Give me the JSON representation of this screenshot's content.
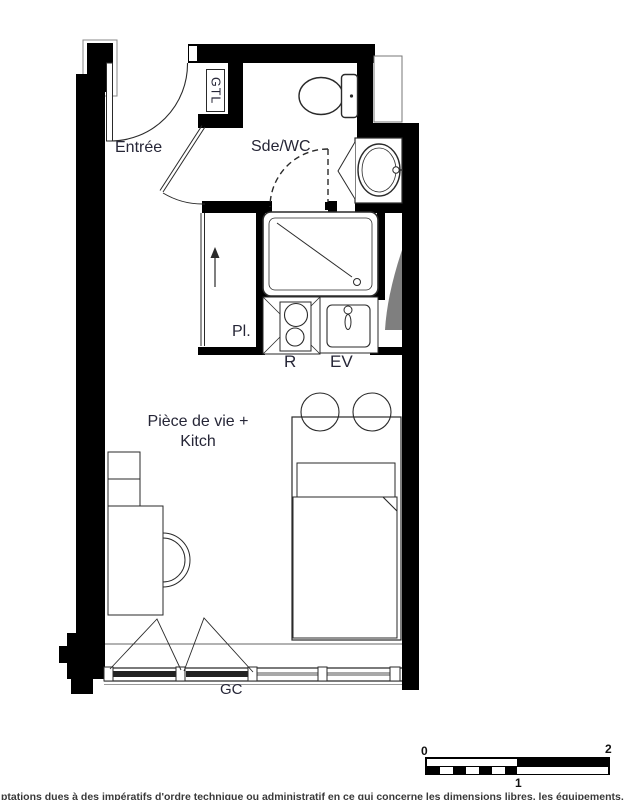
{
  "plan": {
    "title_context": "studio floor plan",
    "labels": {
      "entree": "Entrée",
      "sde_wc": "Sde/WC",
      "gtl": "GTL",
      "placard": "Pl.",
      "appliance_r": "R",
      "sink_ev": "EV",
      "living_line1": "Pièce de vie +",
      "living_line2": "Kitch",
      "guardrail": "GC"
    },
    "colors": {
      "wall": "#000000",
      "label": "#262637",
      "shade_gray": "#7f7f7f",
      "glazing_gray": "#a8a8a8"
    }
  },
  "scale_bar": {
    "start": "0",
    "middle": "1",
    "end": "2"
  },
  "footer": {
    "note": "ptations dues à des impératifs d'ordre technique ou administratif en ce qui concerne les dimensions libres, les équipements, les"
  }
}
